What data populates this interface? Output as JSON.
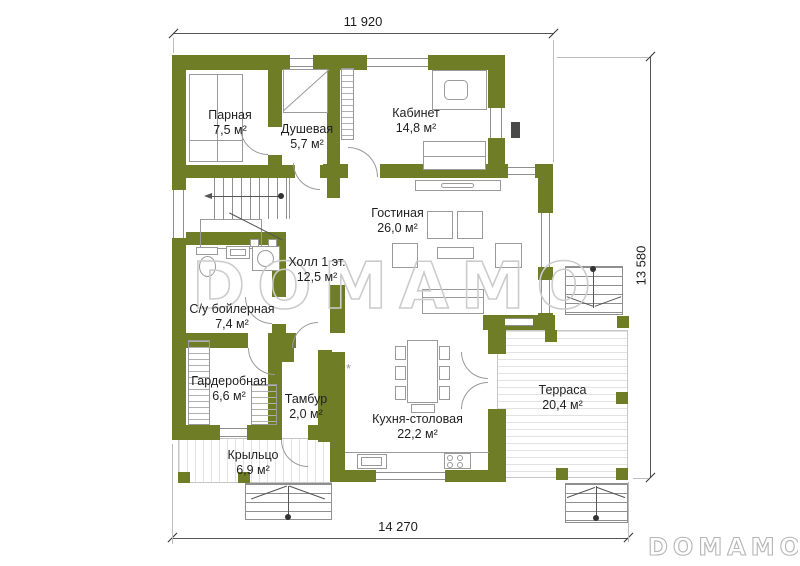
{
  "dimensions": {
    "top": "11 920",
    "right": "13 580",
    "bottom": "14 270"
  },
  "rooms": {
    "parnaya": {
      "name": "Парная",
      "area": "7,5 м²"
    },
    "dushevaya": {
      "name": "Душевая",
      "area": "5,7 м²"
    },
    "kabinet": {
      "name": "Кабинет",
      "area": "14,8 м²"
    },
    "gostinaya": {
      "name": "Гостиная",
      "area": "26,0 м²"
    },
    "holl": {
      "name": "Холл 1 эт.",
      "area": "12,5 м²"
    },
    "su": {
      "name": "С/у бойлерная",
      "area": "7,4 м²"
    },
    "garderobnaya": {
      "name": "Гардеробная",
      "area": "6,6 м²"
    },
    "tambur": {
      "name": "Тамбур",
      "area": "2,0 м²"
    },
    "kuhnya": {
      "name": "Кухня-столовая",
      "area": "22,2 м²"
    },
    "terrasa": {
      "name": "Терраса",
      "area": "20,4 м²"
    },
    "kryltso": {
      "name": "Крыльцо",
      "area": "6,9 м²"
    }
  },
  "watermark": "DOMAMO",
  "logo": "DOMAMO",
  "kitchen_marker": "*",
  "colors": {
    "wall": "#6e7d26",
    "lines": "#9a9a9a",
    "watermark": "#cccccc"
  }
}
